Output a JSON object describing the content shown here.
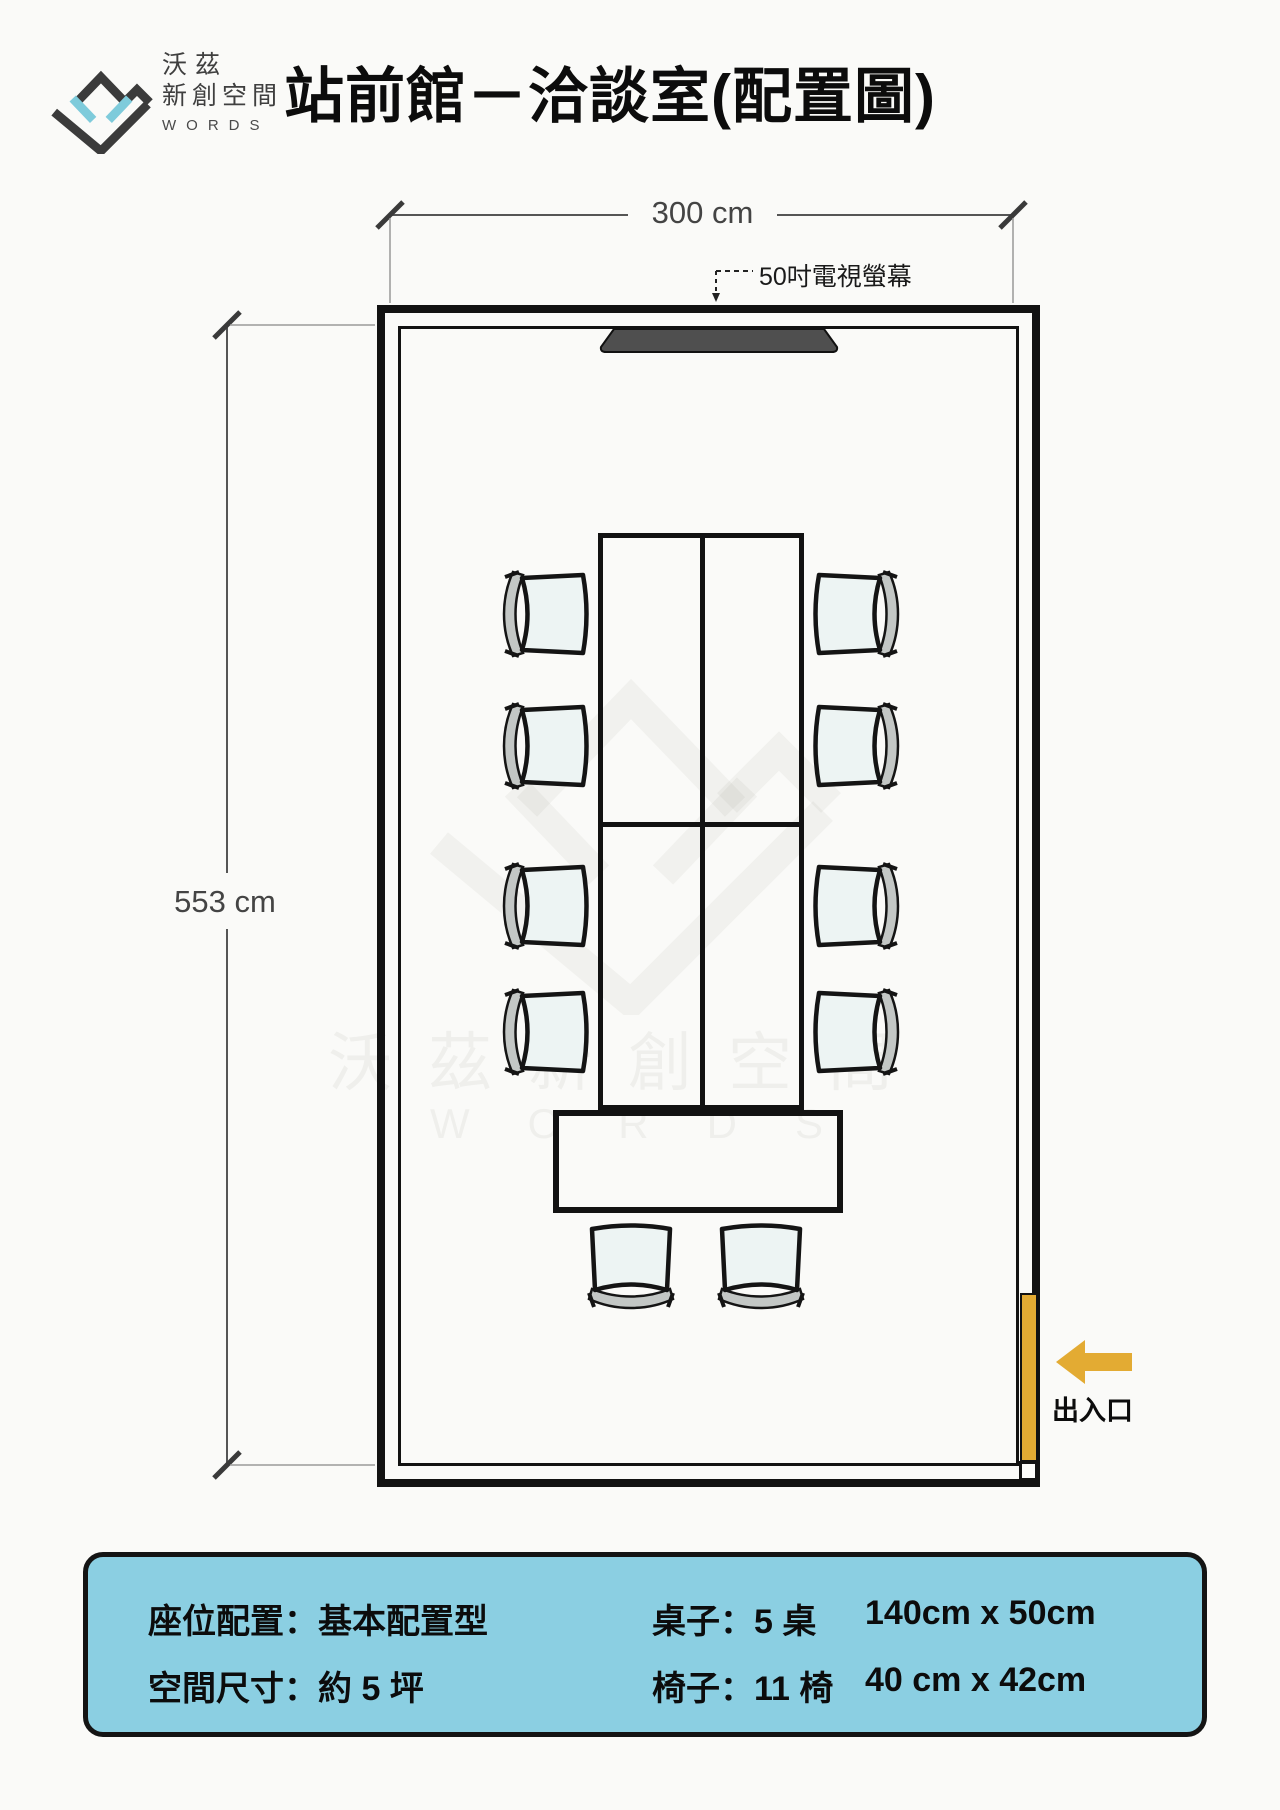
{
  "header": {
    "logo": {
      "line1": "沃茲",
      "line2": "新創空間",
      "line3": "WORDS"
    },
    "title": "站前館－洽談室(配置圖)"
  },
  "plan": {
    "width_label": "300 cm",
    "height_label": "553 cm",
    "tv_label": "50吋電視螢幕",
    "entrance_label": "出入口",
    "watermark_line1": "沃茲新創空間",
    "watermark_line2": "WORDS"
  },
  "info_box": {
    "seat_config": "座位配置：基本配置型",
    "space_size": "空間尺寸：約 5 坪",
    "tables_label": "桌子：5 桌",
    "tables_dims": "140cm x 50cm",
    "chairs_label": "椅子：11 椅",
    "chairs_dims": "40 cm x 42cm"
  },
  "colors": {
    "accent_yellow": "#e3ab33",
    "info_blue": "#8bcfe2",
    "logo_blue": "#7ecbdb",
    "wall_black": "#121212"
  }
}
